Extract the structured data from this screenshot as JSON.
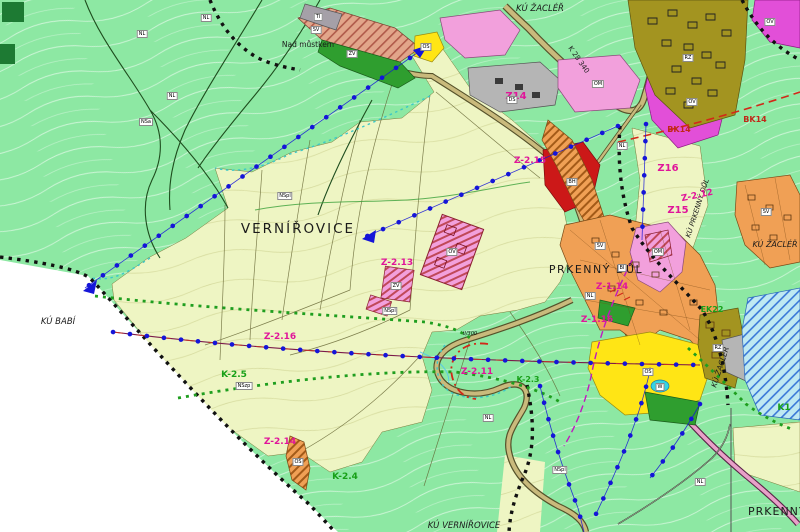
{
  "colors": {
    "forest": "#8de8a3",
    "field": "#eef5c3",
    "outside": "#ffffff",
    "dark_green": "#2f9e2f",
    "orange_zone": "#f0a055",
    "salmon_zone": "#e2a58a",
    "pink_zone": "#f2a0dc",
    "magenta_zone": "#e24fd8",
    "red_zone": "#cc1818",
    "yellow_zone": "#ffe515",
    "olive_zone": "#a39420",
    "gray_zone": "#b5b5b5",
    "water_cyan": "#35d4e4",
    "water_area": "#bfe9f2",
    "road_fill": "#c9ba7c",
    "road_casing": "#55512a",
    "road_pink": "#e8a0c8",
    "blue_line": "#1515d8",
    "green_dotted": "#1f9e1f",
    "red_corridor": "#d22818",
    "purple_dashed": "#c018c0",
    "boundary_black": "#111111",
    "label_magenta": "#e0159a",
    "label_green": "#18a018"
  },
  "map": {
    "place_labels": {
      "ku_zacler_top": "KÚ ŽACLÉŘ",
      "nad_mustkem": "Nad můstkem",
      "vernirovice": "VERNÍŘOVICE",
      "prkenny_dul": "PRKENNÝ DŮL",
      "ku_babi": "KÚ BABÍ",
      "ku_vernirovice": "KÚ VERNÍŘOVICE",
      "prkenny_right": "PRKENNÝ",
      "ku_zacler_right": "KÚ ŽACLÉŘ",
      "ku_zacler_vertical": "KÚ ŽACLÉŘ",
      "ku_prkenny_vertical": "KÚ PRKENNÝ DŮL",
      "road_ref": "K 28 340"
    },
    "zone_labels": {
      "z14": "Z14",
      "z15": "Z15",
      "z16": "Z16"
    },
    "change_zone_labels": {
      "z_2_11": "Z-2.11",
      "z_2_12": "Z-2.12",
      "z_2_13": "Z-2.13",
      "z_2_14": "Z-2.14",
      "z_2_15": "Z-2.15",
      "z_2_16": "Z-2.16",
      "z_1_14": "Z-1.14",
      "z_1_16": "Z-1.16"
    },
    "corridor_labels": {
      "k_2_3": "K-2.3",
      "k_2_4": "K-2.4",
      "k_2_5": "K-2.5",
      "bk14_a": "BK14",
      "bk14_b": "BK14",
      "ek22": "EK22",
      "k1": "K1"
    },
    "parcel_codes": [
      {
        "t": "NL",
        "x": 142,
        "y": 34
      },
      {
        "t": "NL",
        "x": 206,
        "y": 18
      },
      {
        "t": "NL",
        "x": 172,
        "y": 96
      },
      {
        "t": "NL",
        "x": 622,
        "y": 146
      },
      {
        "t": "NL",
        "x": 590,
        "y": 296
      },
      {
        "t": "NL",
        "x": 488,
        "y": 418
      },
      {
        "t": "NL",
        "x": 700,
        "y": 482
      },
      {
        "t": "NSa",
        "x": 146,
        "y": 122
      },
      {
        "t": "NSzp",
        "x": 244,
        "y": 386
      },
      {
        "t": "NSpl",
        "x": 285,
        "y": 196
      },
      {
        "t": "NSpl",
        "x": 390,
        "y": 311
      },
      {
        "t": "NSpl",
        "x": 560,
        "y": 470
      },
      {
        "t": "OS",
        "x": 426,
        "y": 47
      },
      {
        "t": "OS",
        "x": 648,
        "y": 372
      },
      {
        "t": "OS",
        "x": 298,
        "y": 462
      },
      {
        "t": "ZV",
        "x": 352,
        "y": 54
      },
      {
        "t": "ZV",
        "x": 396,
        "y": 286
      },
      {
        "t": "W",
        "x": 660,
        "y": 387
      },
      {
        "t": "RZ",
        "x": 688,
        "y": 58
      },
      {
        "t": "RZ",
        "x": 718,
        "y": 348
      },
      {
        "t": "OM",
        "x": 598,
        "y": 84
      },
      {
        "t": "OM",
        "x": 658,
        "y": 252
      },
      {
        "t": "OV",
        "x": 692,
        "y": 102
      },
      {
        "t": "OV",
        "x": 770,
        "y": 22
      },
      {
        "t": "BH",
        "x": 572,
        "y": 182
      },
      {
        "t": "TI",
        "x": 318,
        "y": 17
      },
      {
        "t": "SV",
        "x": 316,
        "y": 30
      },
      {
        "t": "SV",
        "x": 600,
        "y": 246
      },
      {
        "t": "BI",
        "x": 622,
        "y": 268
      },
      {
        "t": "SV",
        "x": 766,
        "y": 212
      },
      {
        "t": "DS",
        "x": 512,
        "y": 100
      },
      {
        "t": "OV",
        "x": 452,
        "y": 252
      },
      {
        "t": "II/300",
        "x": 470,
        "y": 334,
        "box": false
      }
    ]
  }
}
